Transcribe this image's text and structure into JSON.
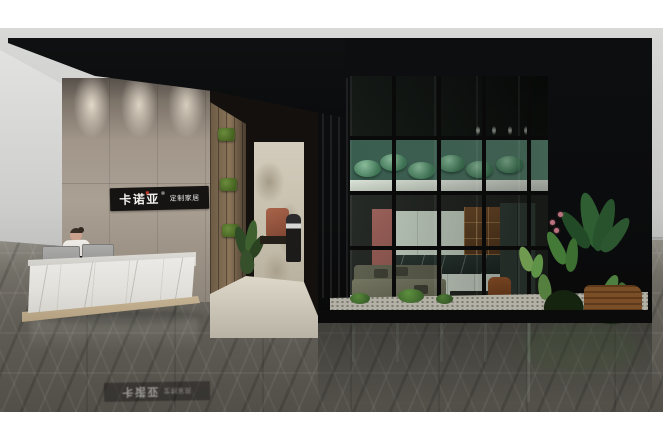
{
  "brand_sign": {
    "main": "卡诺亚",
    "registered": "®",
    "sub": "定制家居"
  },
  "floor_reflection": {
    "main": "卡诺亚",
    "sub": "定制家居"
  },
  "palette": {
    "page_bg": "#ffffff",
    "backdrop_wall": "#cbcbc9",
    "canopy_black": "#0d0e10",
    "concrete_wall": "#a19689",
    "side_wall": "#dedede",
    "sign_bg": "#161412",
    "sign_text": "#f2f0ec",
    "sign_accent_red": "#c03a2b",
    "desk_marble": "#eceae6",
    "plinth_beige": "#cdbb9c",
    "wood_wall": "#7c6950",
    "moss_green": "#55752f",
    "stone_wall": "#cfc8b8",
    "mezzanine_green": "#47705f",
    "lotus_chair_green": "#58926f",
    "balustrade_white": "#e3eadf",
    "kitchen_cabinet_sage": "#cbd5c8",
    "pink_accent_wall": "#9a5c52",
    "sofa_olive": "#74755f",
    "butterfly_chair_rust": "#93512a",
    "plant_dark_green": "#2e5a32",
    "flower_pink": "#bd7280",
    "gravel": "#b3b0a5",
    "marble_floor_dark": "#524f49",
    "marble_floor_light": "#8e8b83"
  }
}
